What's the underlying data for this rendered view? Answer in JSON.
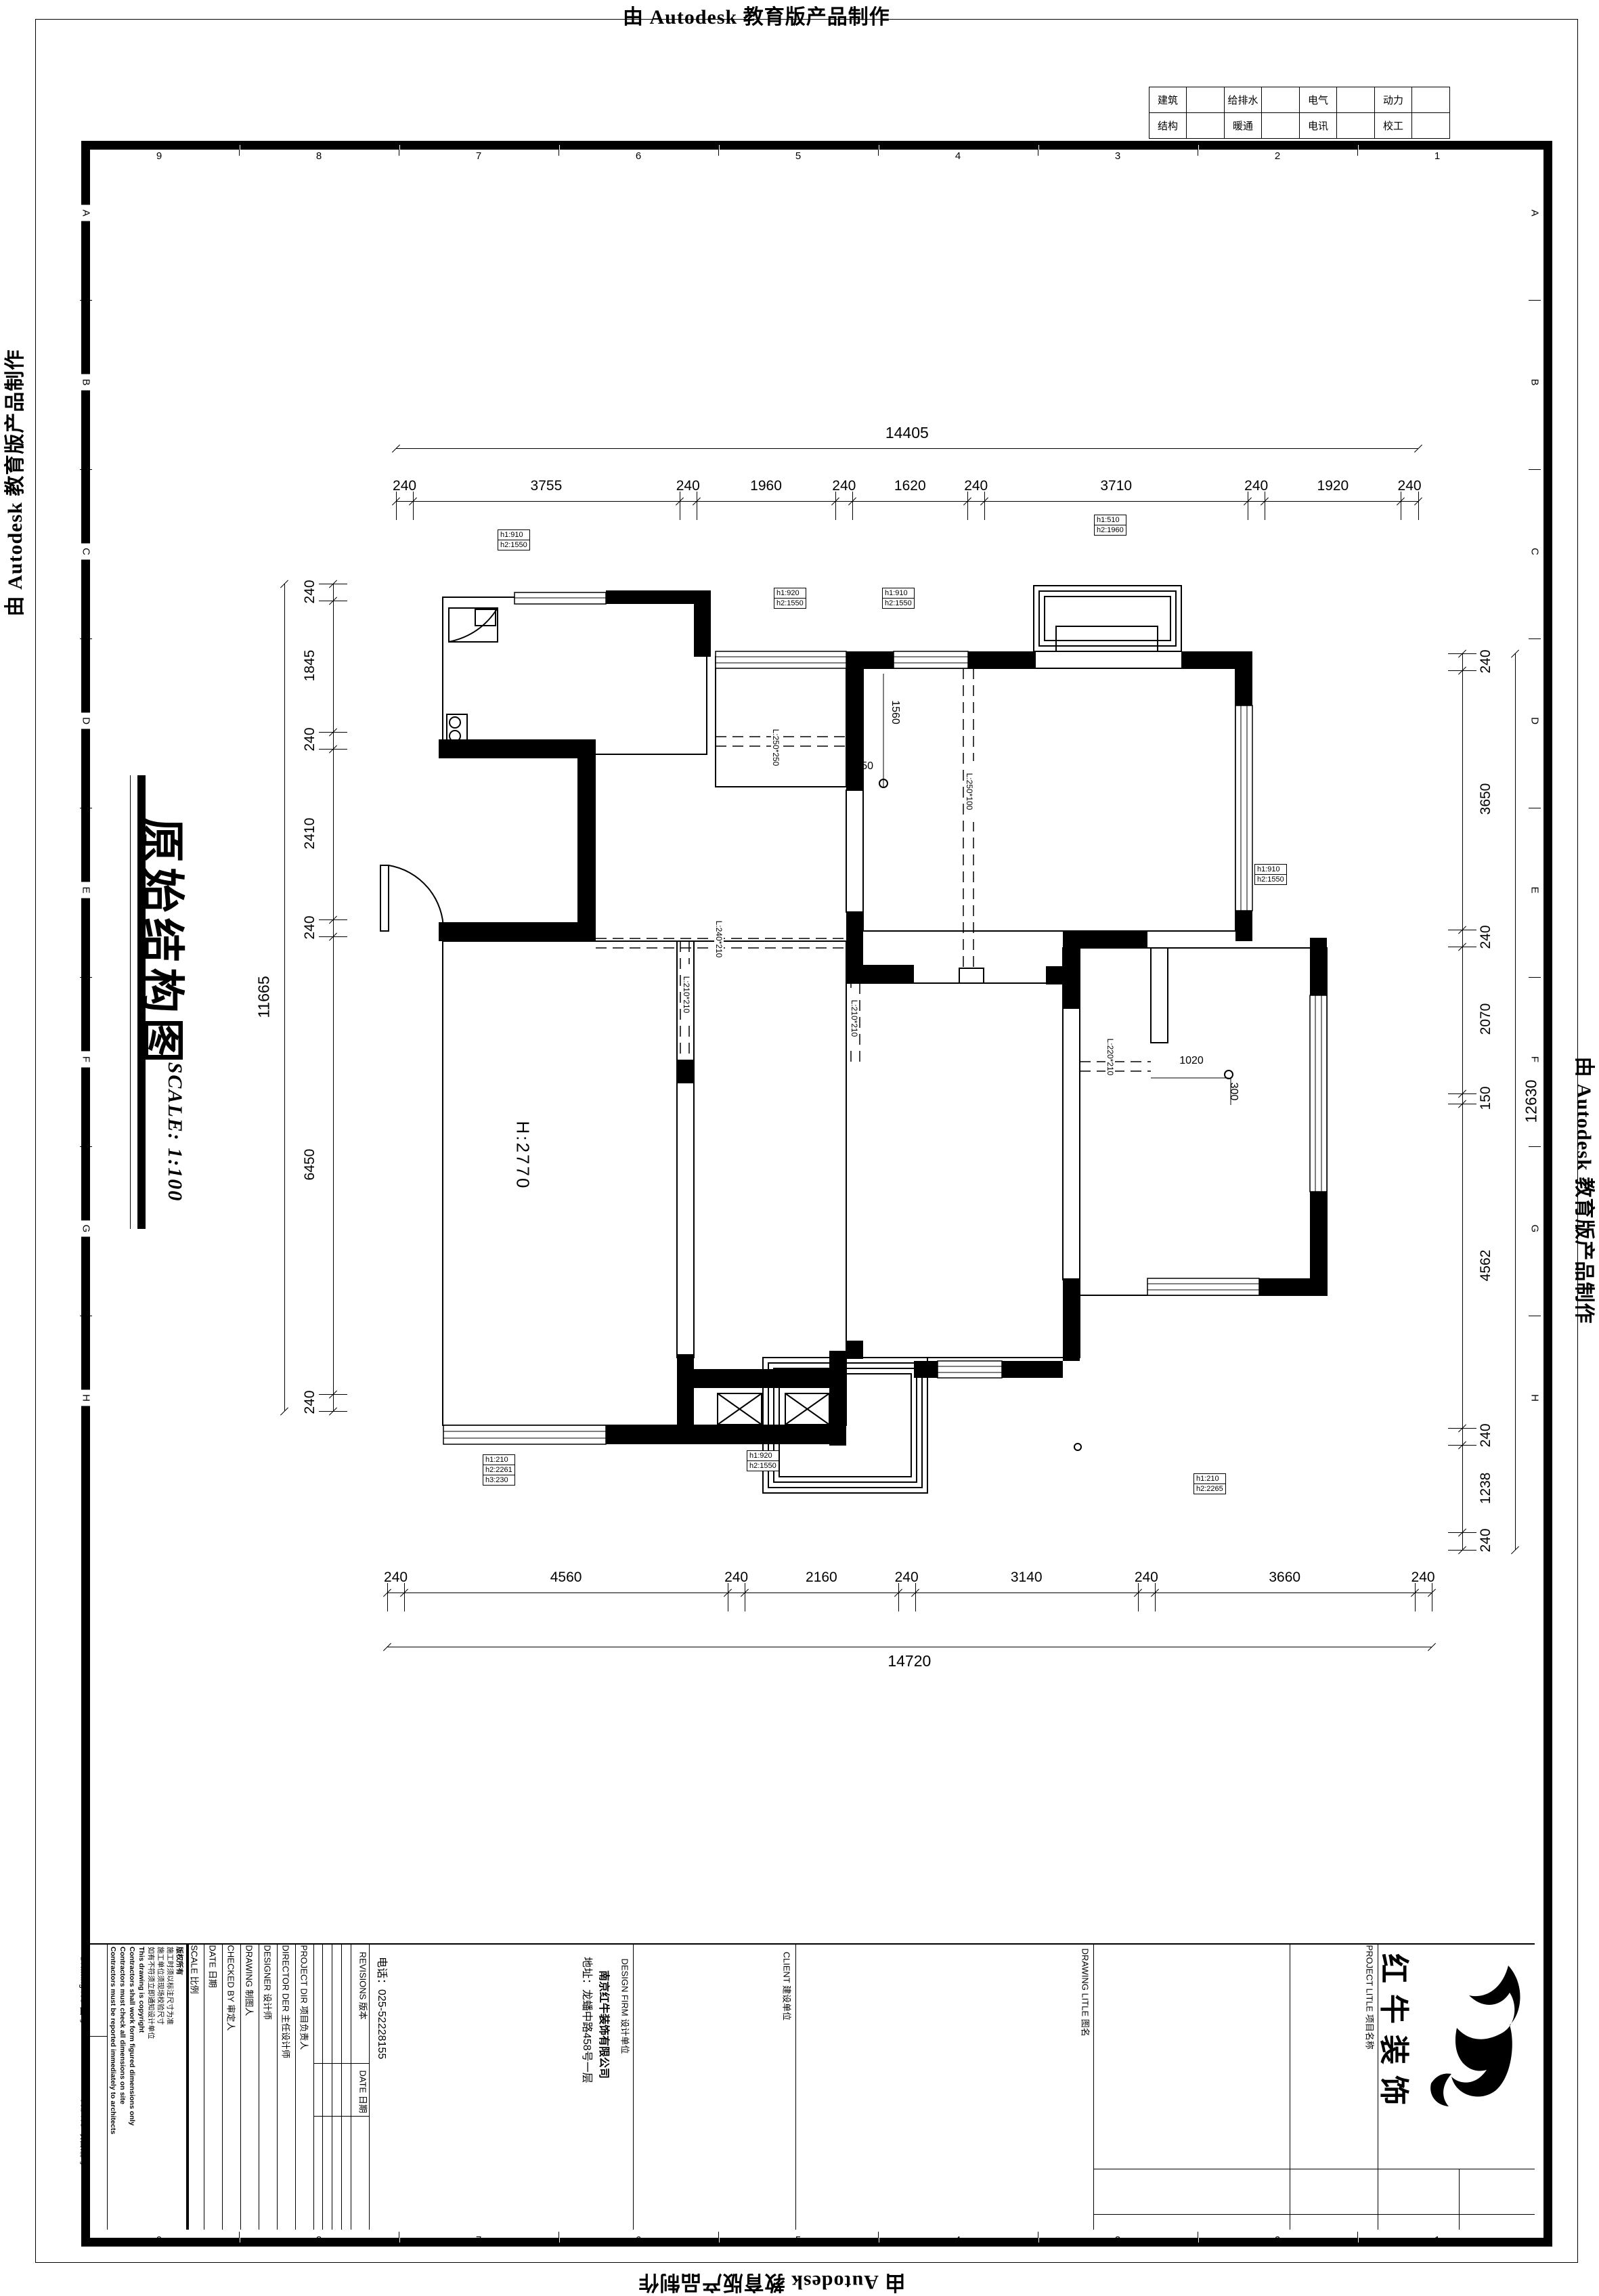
{
  "stamp": {
    "text": "由 Autodesk 教育版产品制作"
  },
  "frame": {
    "top_numbers": [
      "9",
      "8",
      "7",
      "6",
      "5",
      "4",
      "3",
      "2",
      "1"
    ],
    "bottom_numbers": [
      "9",
      "8",
      "7",
      "6",
      "5",
      "4",
      "3",
      "2",
      "1"
    ],
    "left_letters": [
      "A",
      "B",
      "C",
      "D",
      "E",
      "F",
      "G",
      "H"
    ],
    "right_letters": [
      "A",
      "B",
      "C",
      "D",
      "E",
      "F",
      "G",
      "H"
    ]
  },
  "consultant_table": {
    "rows": [
      {
        "cells": [
          "建筑",
          "给排水",
          "电气",
          "动力"
        ]
      },
      {
        "cells": [
          "结构",
          "暖通",
          "电讯",
          "校工"
        ]
      }
    ]
  },
  "drawing_title": {
    "title": "原始结构图",
    "scale": "SCALE: 1:100"
  },
  "plan": {
    "room_height": "H:2770",
    "window_labels": [
      {
        "rows": [
          "h1:910",
          "h2:1550"
        ]
      },
      {
        "rows": [
          "h1:920",
          "h2:1550"
        ]
      },
      {
        "rows": [
          "h1:910",
          "h2:1550"
        ]
      },
      {
        "rows": [
          "h1:510",
          "h2:1960"
        ]
      },
      {
        "rows": [
          "h1:910",
          "h2:1550"
        ]
      },
      {
        "rows": [
          "h1:210",
          "h2:2261",
          "h3:230"
        ]
      },
      {
        "rows": [
          "h1:920",
          "h2:1550"
        ]
      },
      {
        "rows": [
          "h1:210",
          "h2:2265"
        ]
      }
    ],
    "beam_labels": [
      "L:250*250",
      "L:250*100",
      "L:240*210",
      "L:210*210",
      "L:210*210",
      "L:220*210"
    ],
    "inline_dims": [
      "1560",
      "350",
      "1020",
      "300"
    ]
  },
  "dimensions": {
    "top": {
      "total": "14405",
      "segments": [
        "240",
        "3755",
        "240",
        "1960",
        "240",
        "1620",
        "240",
        "3710",
        "240",
        "1920",
        "240"
      ]
    },
    "bottom": {
      "total": "14720",
      "segments": [
        "240",
        "4560",
        "240",
        "2160",
        "240",
        "3140",
        "240",
        "3660",
        "240"
      ]
    },
    "left": {
      "total": "11665",
      "segments": [
        "240",
        "1845",
        "240",
        "2410",
        "240",
        "6450",
        "240"
      ]
    },
    "right": {
      "total": "12630",
      "segments": [
        "240",
        "3650",
        "240",
        "2070",
        "150",
        "4562",
        "240",
        "1238",
        "240"
      ]
    }
  },
  "title_block": {
    "drawing_no_label": "Drawing NO 图号",
    "job_no_label": "Job NO 项目编号",
    "notes": [
      "版权所有",
      "施工时须以标注尺寸为准",
      "施工单位须现场校验尺寸",
      "如有不符须立即通知设计单位",
      "This drawing is copyright",
      "Contractors shall work form figured dimensions only",
      "Contractors must check all dimensions on site",
      "Contractors must be reported immediately to architects"
    ],
    "columns": [
      "SCALE 比例",
      "DATE 日期",
      "CHECKED BY 审定人",
      "DRAWING 制图人",
      "DESIGNER 设计师",
      "DIRECTOR DER 主任设计师",
      "PROJECT DIR 项目负责人"
    ],
    "revisions_label": "REVISIONS 版本",
    "revisions_date_label": "DATE 日期",
    "design_firm_label": "DESIGN FIRM 设计单位",
    "company": "南京红牛装饰有限公司",
    "address": "地址：龙蟠中路458号一层",
    "phone": "电话：025-52228155",
    "client_label": "CLIENT 建设单位",
    "drawing_title_label": "DRAWING LITLE 图名",
    "project_title_label": "PROJECT LITLE 项目名称",
    "brand": "红牛装饰"
  },
  "colors": {
    "ink": "#000000",
    "paper": "#ffffff"
  }
}
